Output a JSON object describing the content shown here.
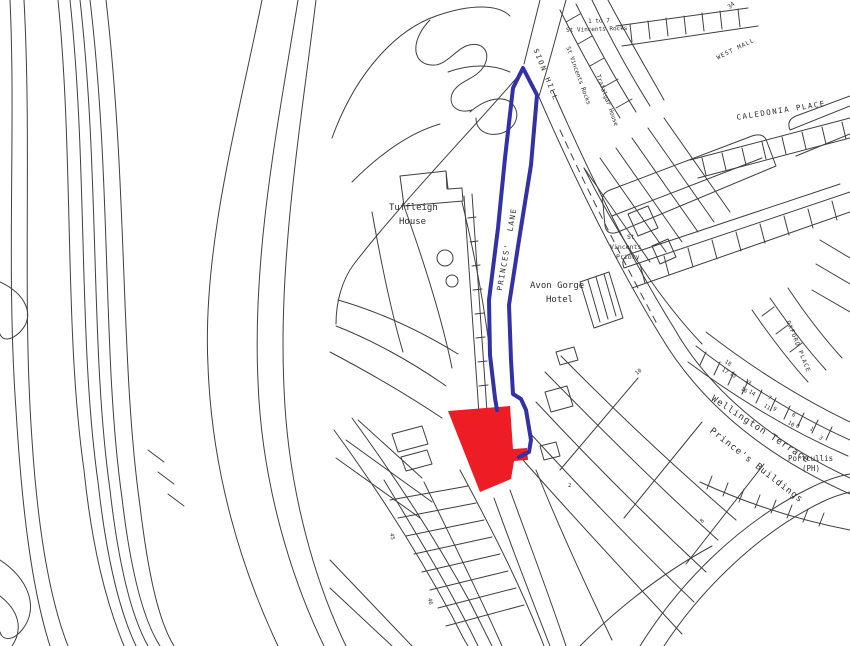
{
  "map": {
    "kind": "site-location-plan",
    "background_color": "#ffffff",
    "linework_color": "#3f3f3f",
    "site": {
      "label": "application-site",
      "fill": "#ee1c24"
    },
    "boundary": {
      "label": "site-boundary",
      "stroke": "#3231a8"
    },
    "labels": [
      {
        "id": "no-34",
        "text": "34",
        "x": 727,
        "y": 6,
        "rot": -38,
        "size": 6
      },
      {
        "id": "one-to-7",
        "text": "1 to 7",
        "x": 588,
        "y": 19,
        "rot": -2,
        "size": 6
      },
      {
        "id": "st-vincents-rocks",
        "text": "St Vincents Rocks",
        "x": 566,
        "y": 28,
        "rot": -2,
        "size": 6
      },
      {
        "id": "sion-hill",
        "text": "SION HILL",
        "x": 538,
        "y": 48,
        "rot": 68,
        "size": 7,
        "ls": 2
      },
      {
        "id": "st-vincents-rocks-terrace",
        "text": "St Vincents Rocks",
        "x": 570,
        "y": 46,
        "rot": 70,
        "size": 6
      },
      {
        "id": "trafalgar-house",
        "text": "Trafalgar House",
        "x": 600,
        "y": 74,
        "rot": 70,
        "size": 6
      },
      {
        "id": "west-mall",
        "text": "WEST MALL",
        "x": 716,
        "y": 56,
        "rot": -26,
        "size": 6,
        "ls": 1
      },
      {
        "id": "caledonia-place",
        "text": "CALEDONIA PLACE",
        "x": 736,
        "y": 114,
        "rot": -9,
        "size": 7.5,
        "ls": 1.5
      },
      {
        "id": "tuffleigh-house-1",
        "text": "Tuffleigh",
        "x": 389,
        "y": 204,
        "rot": 0,
        "size": 9
      },
      {
        "id": "tuffleigh-house-2",
        "text": "House",
        "x": 399,
        "y": 218,
        "rot": 0,
        "size": 9
      },
      {
        "id": "princes-lane",
        "text": "PRINCES'  LANE",
        "x": 496,
        "y": 290,
        "rot": -80,
        "size": 7.5,
        "ls": 1.5
      },
      {
        "id": "avon-gorge-hotel-1",
        "text": "Avon Gorge",
        "x": 530,
        "y": 282,
        "rot": 0,
        "size": 9
      },
      {
        "id": "avon-gorge-hotel-2",
        "text": "Hotel",
        "x": 546,
        "y": 296,
        "rot": 0,
        "size": 9
      },
      {
        "id": "st-vincents-priory-1",
        "text": "St",
        "x": 627,
        "y": 234,
        "rot": 0,
        "size": 6.5
      },
      {
        "id": "st-vincents-priory-2",
        "text": "Vincents",
        "x": 610,
        "y": 244,
        "rot": 0,
        "size": 6.5
      },
      {
        "id": "st-vincents-priory-3",
        "text": "Priory",
        "x": 616,
        "y": 254,
        "rot": 0,
        "size": 6.5
      },
      {
        "id": "oxford-place",
        "text": "OXFORD PLACE",
        "x": 790,
        "y": 320,
        "rot": 68,
        "size": 6,
        "ls": 1
      },
      {
        "id": "wellington-terrace",
        "text": "Wellington Terrace",
        "x": 714,
        "y": 395,
        "rot": 33,
        "size": 9,
        "ls": 1
      },
      {
        "id": "princes-buildings",
        "text": "Prince's Buildings",
        "x": 713,
        "y": 427,
        "rot": 38,
        "size": 9,
        "ls": 1
      },
      {
        "id": "portcullis-1",
        "text": "Portcullis",
        "x": 788,
        "y": 455,
        "rot": 0,
        "size": 7.5
      },
      {
        "id": "portcullis-2",
        "text": "(PH)",
        "x": 802,
        "y": 465,
        "rot": 0,
        "size": 7.5
      },
      {
        "id": "no-18",
        "text": "18",
        "x": 726,
        "y": 360,
        "rot": 33,
        "size": 5.5
      },
      {
        "id": "no-17",
        "text": "17",
        "x": 723,
        "y": 368,
        "rot": 33,
        "size": 5.5
      },
      {
        "id": "no-15",
        "text": "15",
        "x": 731,
        "y": 372,
        "rot": 33,
        "size": 5.5
      },
      {
        "id": "no-13",
        "text": "13",
        "x": 746,
        "y": 379,
        "rot": 33,
        "size": 5.5
      },
      {
        "id": "no-16",
        "text": "16",
        "x": 742,
        "y": 387,
        "rot": 33,
        "size": 5.5
      },
      {
        "id": "no-14",
        "text": "14",
        "x": 750,
        "y": 390,
        "rot": 33,
        "size": 5.5
      },
      {
        "id": "no-7",
        "text": "7",
        "x": 769,
        "y": 396,
        "rot": 33,
        "size": 5.5
      },
      {
        "id": "no-11",
        "text": "11",
        "x": 765,
        "y": 404,
        "rot": 33,
        "size": 5.5
      },
      {
        "id": "no-9",
        "text": "9",
        "x": 774,
        "y": 407,
        "rot": 33,
        "size": 5.5
      },
      {
        "id": "no-6",
        "text": "6",
        "x": 793,
        "y": 413,
        "rot": 33,
        "size": 5.5
      },
      {
        "id": "no-10",
        "text": "10",
        "x": 789,
        "y": 421,
        "rot": 33,
        "size": 5.5
      },
      {
        "id": "no-8",
        "text": "8",
        "x": 797,
        "y": 424,
        "rot": 33,
        "size": 5.5
      },
      {
        "id": "no-1",
        "text": "1",
        "x": 811,
        "y": 427,
        "rot": 33,
        "size": 5.5
      },
      {
        "id": "no-3",
        "text": "3",
        "x": 820,
        "y": 436,
        "rot": 33,
        "size": 5.5
      },
      {
        "id": "no-2",
        "text": "2",
        "x": 568,
        "y": 484,
        "rot": 0,
        "size": 5.5
      },
      {
        "id": "no-10b",
        "text": "10",
        "x": 635,
        "y": 373,
        "rot": -40,
        "size": 5.5
      },
      {
        "id": "no-8b",
        "text": "8",
        "x": 700,
        "y": 521,
        "rot": -40,
        "size": 5.5
      },
      {
        "id": "no-45",
        "text": "45",
        "x": 393,
        "y": 533,
        "rot": 80,
        "size": 5.5
      },
      {
        "id": "no-46",
        "text": "46",
        "x": 431,
        "y": 598,
        "rot": 80,
        "size": 5.5
      }
    ]
  }
}
